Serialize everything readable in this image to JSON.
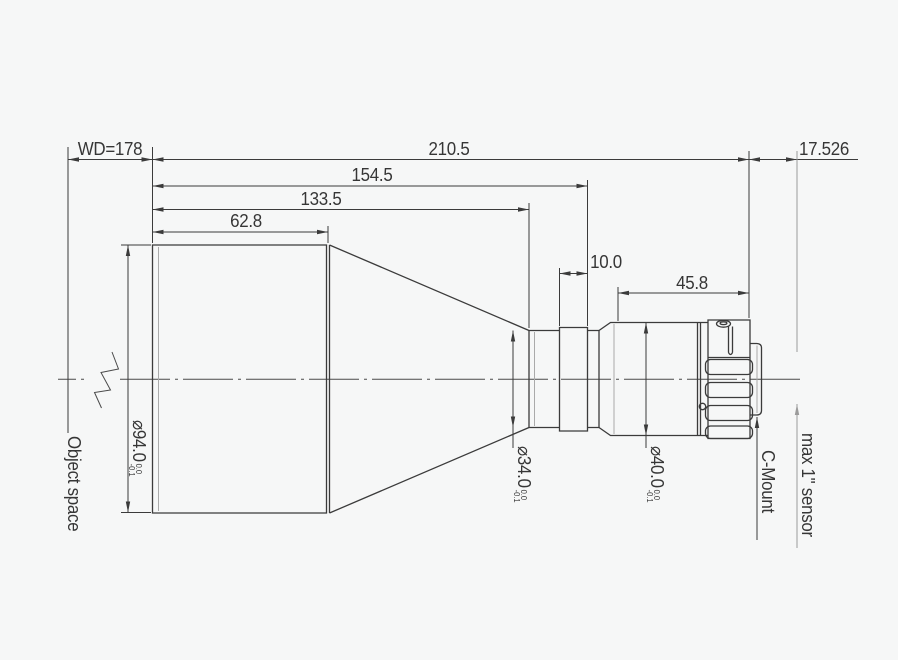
{
  "drawing": {
    "background": "#f6f7f7",
    "line_color": "#3b3b3b",
    "dimensions": {
      "working_distance": "WD=178",
      "overall_length": "210.5",
      "flange_distance": "17.526",
      "front_to_ring_rear": "154.5",
      "front_to_tube_face": "133.5",
      "front_barrel_length": "62.8",
      "ring_width": "10.0",
      "rear_barrel_length": "45.8"
    },
    "diameters": {
      "front": {
        "value": "⌀94.0",
        "tol_upper": "0.0",
        "tol_lower": "-0.1"
      },
      "mid": {
        "value": "⌀34.0",
        "tol_upper": "0.0",
        "tol_lower": "-0.1"
      },
      "rear": {
        "value": "⌀40.0",
        "tol_upper": "0.0",
        "tol_lower": "-0.1"
      }
    },
    "annotations": {
      "object_space": "Object space",
      "c_mount": "C-Mount",
      "max_sensor": "max 1\" sensor"
    }
  }
}
